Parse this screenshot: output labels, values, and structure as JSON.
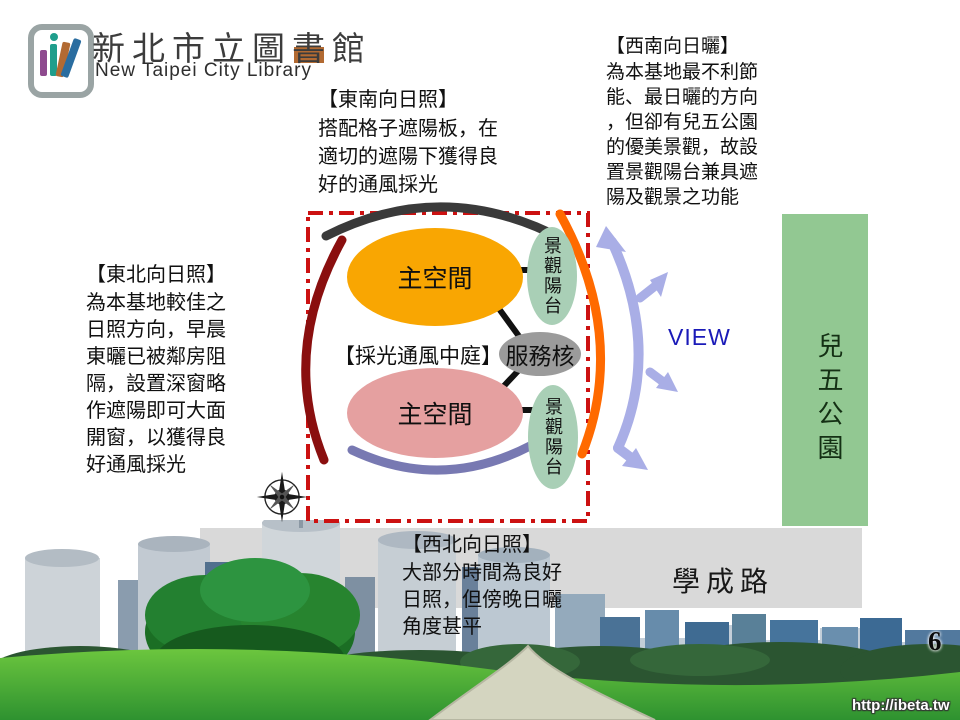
{
  "header": {
    "logo_title": "新北市立圖書館",
    "logo_subtitle": "New Taipei City Library"
  },
  "annotations": {
    "southeast": {
      "title": "【東南向日照】",
      "lines": [
        "搭配格子遮陽板，在",
        "適切的遮陽下獲得良",
        "好的通風採光"
      ]
    },
    "southwest": {
      "title": "【西南向日曬】",
      "lines": [
        "為本基地最不利節",
        "能、最日曬的方向",
        "，但卻有兒五公園",
        "的優美景觀，故設",
        "置景觀陽台兼具遮",
        "陽及觀景之功能"
      ]
    },
    "northeast": {
      "title": "【東北向日照】",
      "lines": [
        "為本基地較佳之",
        "日照方向，早晨",
        "東曬已被鄰房阻",
        "隔，設置深窗略",
        "作遮陽即可大面",
        "開窗，以獲得良",
        "好通風採光"
      ]
    },
    "northwest": {
      "title": "【西北向日照】",
      "lines": [
        "大部分時間為良好",
        "日照，但傍晚日曬",
        "角度甚平"
      ]
    }
  },
  "diagram": {
    "main_space_top": "主空間",
    "main_space_bottom": "主空間",
    "balcony_top": "景觀陽台",
    "balcony_bottom": "景觀陽台",
    "service_core": "服務核",
    "atrium_label": "【採光通風中庭】",
    "view_label": "VIEW"
  },
  "site": {
    "park_label": "兒五公園",
    "road_label": "學成路"
  },
  "footer": {
    "page_number": "6",
    "watermark": "http://ibeta.tw"
  },
  "icons": {
    "compass": "compass-rose",
    "logo": "library-books-logo"
  },
  "colors": {
    "site_boundary_red": "#CC1111",
    "main_space_top_orange": "#F9A602",
    "main_space_bottom_pink": "#E5A0A0",
    "balcony_green": "#A9CFB6",
    "service_core_gray": "#9B9B9B",
    "park_green": "#92C892",
    "road_gray": "#D9D9D9",
    "north_arc_black": "#3A3A3A",
    "east_arc_darkred": "#8A0F0F",
    "west_arc_orange": "#FF6A00",
    "south_arc_slate": "#7879B2",
    "view_arrow_lavender": "#A9AEE6",
    "view_text_blue": "#1A1AB8"
  }
}
